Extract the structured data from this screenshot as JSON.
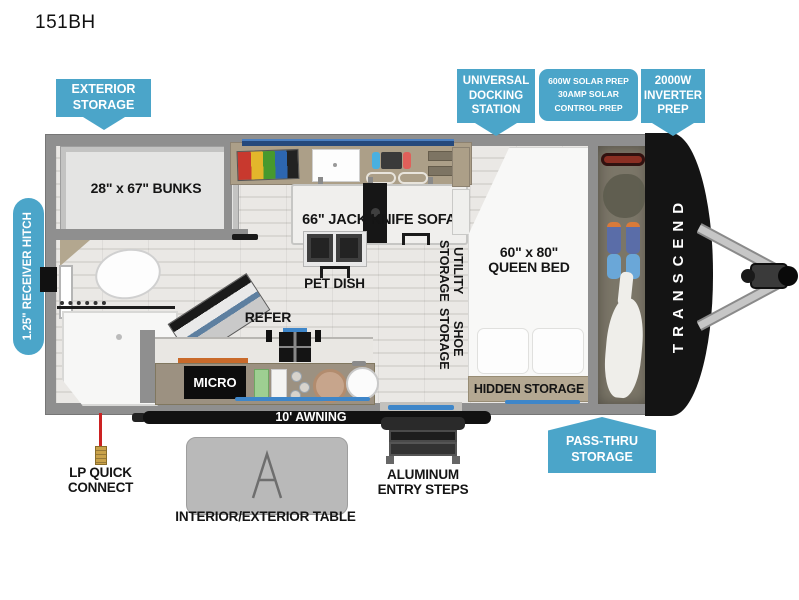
{
  "title": "151BH",
  "colors": {
    "callout": "#4BA5C9",
    "wall": "#8F8F8F",
    "front_cap": "#141414",
    "accent_blue": "#3E86C9",
    "cabinet_tan": "#AC9F88"
  },
  "callouts": {
    "exterior_storage": "EXTERIOR\nSTORAGE",
    "universal_docking": "UNIVERSAL\nDOCKING\nSTATION",
    "solar_prep": "600W SOLAR PREP\n30AMP SOLAR\nCONTROL PREP",
    "inverter_prep": "2000W\nINVERTER\nPREP",
    "receiver_hitch": "1.25\" RECEIVER HITCH",
    "pass_thru": "PASS-THRU\nSTORAGE"
  },
  "plan": {
    "bunks": "28\" x 67\" BUNKS",
    "sofa": "66\" JACK KNIFE SOFA",
    "pet_dish": "PET DISH",
    "utility_storage": "UTILITY\nSTORAGE",
    "shoe_storage": "SHOE\nSTORAGE",
    "queen_bed": "60\" x 80\"\nQUEEN BED",
    "hidden_storage": "HIDDEN STORAGE",
    "refer": "REFER",
    "micro": "MICRO",
    "awning": "10' AWNING",
    "brand": "TRANSCEND"
  },
  "exterior": {
    "lp_connect": "LP QUICK\nCONNECT",
    "table": "INTERIOR/EXTERIOR TABLE",
    "steps": "ALUMINUM\nENTRY STEPS"
  }
}
